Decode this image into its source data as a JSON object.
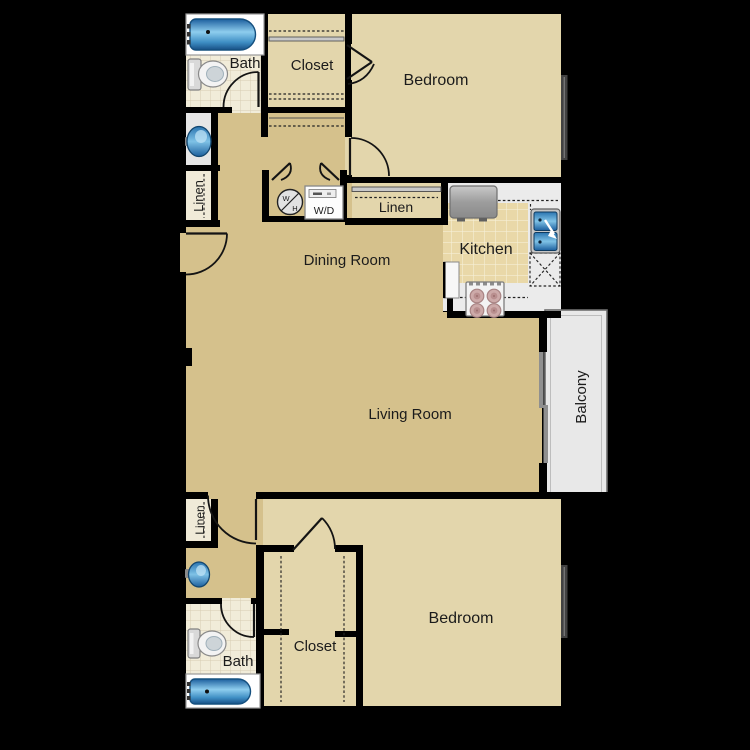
{
  "plan": {
    "labels": {
      "bath_top": "Bath",
      "closet_top": "Closet",
      "bedroom_top": "Bedroom",
      "linen_left": "Linen",
      "wh_w": "W",
      "wh_h": "H",
      "wd": "W/D",
      "linen_right": "Linen",
      "kitchen": "Kitchen",
      "dining": "Dining Room",
      "living": "Living Room",
      "balcony": "Balcony",
      "linen_lower": "Linen",
      "bedroom_bottom": "Bedroom",
      "closet_bottom": "Closet",
      "bath_bottom": "Bath"
    },
    "colors": {
      "background": "#000000",
      "wall": "#000000",
      "carpet": "#d5c18c",
      "carpet_light": "#e3d6ac",
      "bath_tile": "#f1ecd9",
      "bath_grout": "#d8cdb2",
      "kitchen_tile": "#e9d8a8",
      "kitchen_grout": "#f6efd6",
      "counter": "#ebebeb",
      "balcony": "#e8e8e8",
      "closet_shelf": "#f0ead8",
      "nook_floor": "#e6e6e6",
      "fixture_blue_dark": "#1c5f9e",
      "fixture_blue_light": "#8ecdee",
      "appliance_gray": "#b5b5b5",
      "burner": "#c29a9a",
      "window_gray": "#424242",
      "label_ink": "#1b1b1b"
    }
  }
}
